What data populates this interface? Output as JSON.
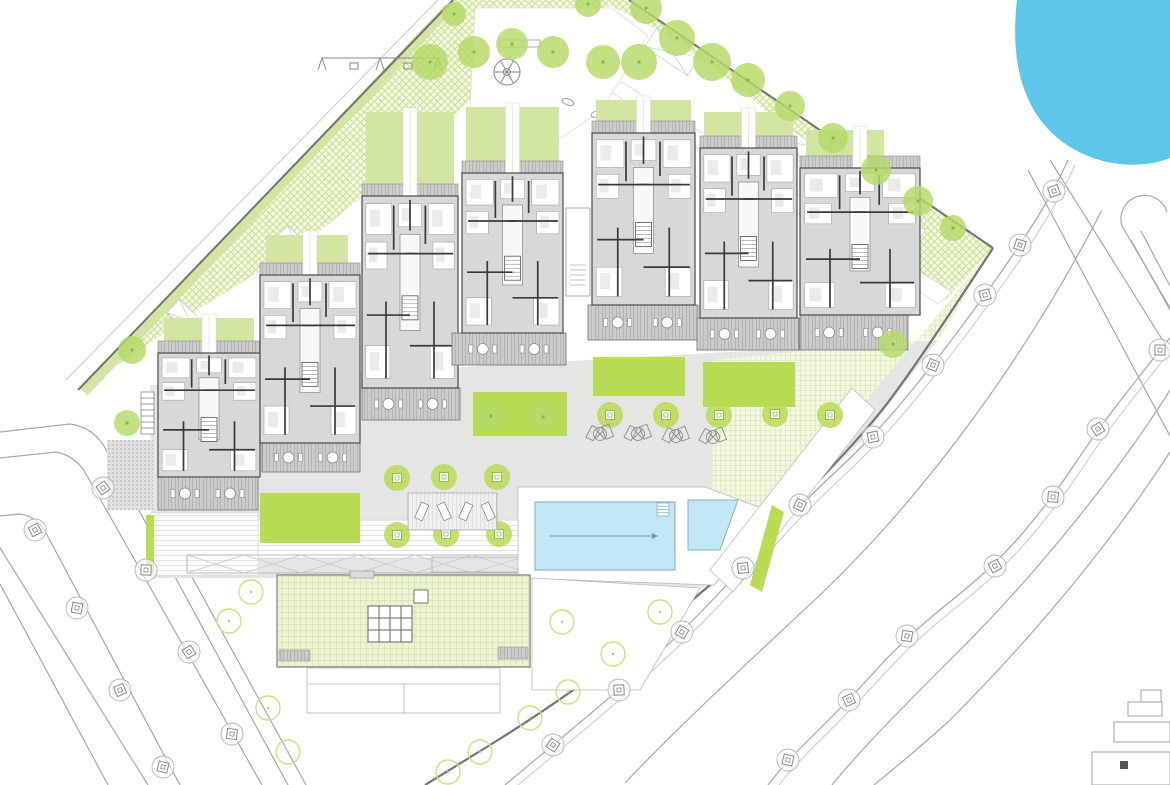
{
  "canvas": {
    "w": 1170,
    "h": 785
  },
  "colors": {
    "water": "#5ec6e9",
    "pool": "#c2e7f7",
    "pool_stroke": "#85b3c6",
    "tree_canopy": "#b5da68",
    "tree_dot": "#8cba42",
    "bed_bright": "#b9dc55",
    "strip_muted": "#d2e5a3",
    "hatch_line": "#c9e18e",
    "hatch_bg": "#f3f8e5",
    "grid_line": "#cbe292",
    "grid_bg": "#f2f7e2",
    "roof_line": "#c3dd8f",
    "roof_bg": "#ecf3d4",
    "building_fill": "#d8d8d8",
    "building_stroke": "#4a4a4a",
    "wall": "#3a3a3a",
    "room_stroke": "#9b9b9b",
    "balcony_bg": "#cbcbcb",
    "balcony_line": "#999999",
    "plaza": "#e5e5e3",
    "road": "#a8a8a8",
    "road_light": "#c9c9c9",
    "boundary": "#757575",
    "outline_tree": "#cbe283",
    "street_tree_circle": "#b5b5b5",
    "street_tree_square": "#8a8a8a",
    "white": "#ffffff"
  },
  "water": {
    "path": "M 1017,0 C 1010,60 1022,110 1060,140 C 1095,167 1140,170 1170,158 L 1170,0 Z"
  },
  "roads": {
    "plain": [
      "M 0,432 L 70,424 Q 92,427 104,446 L 288,785",
      "M 0,458 L 56,452 Q 76,456 86,474 L 262,785",
      "M 118,442 L 306,785",
      "M 0,516 L 20,514 Q 38,517 46,533 L 180,785",
      "M 0,548 L 148,785",
      "M 0,584 L 108,785",
      "M 1102,210 C 1030,350 930,490 820,595 C 740,670 680,725 625,783",
      "M 1170,390 C 1120,470 1040,570 960,650 C 900,710 862,748 832,785",
      "M 1170,452 C 1110,545 1030,640 950,720 C 915,752 892,770 874,785",
      "M 1028,170 L 1170,436",
      "M 1050,160 L 1170,352"
    ],
    "capsule": [
      "M 1122,226 A 22,22 0 1 1 1167,212",
      "M 1122,226 L 1170,308",
      "M 1131,240 L 1170,310",
      "M 1141,231 L 1170,286"
    ],
    "rows": [
      {
        "pts": [
          [
            1068,
            160
          ],
          [
            1054,
            191
          ],
          [
            1020,
            245
          ],
          [
            985,
            295
          ],
          [
            933,
            365
          ],
          [
            873,
            437
          ],
          [
            800,
            505
          ],
          [
            743,
            568
          ],
          [
            682,
            632
          ],
          [
            619,
            690
          ],
          [
            553,
            745
          ],
          [
            505,
            785
          ]
        ]
      },
      {
        "pts": [
          [
            1170,
            338
          ],
          [
            1160,
            350
          ],
          [
            1098,
            429
          ],
          [
            1053,
            497
          ],
          [
            995,
            566
          ],
          [
            907,
            636
          ],
          [
            849,
            700
          ],
          [
            788,
            760
          ],
          [
            768,
            785
          ]
        ]
      }
    ]
  },
  "boundaries": {
    "left": [
      [
        453,
        0
      ],
      [
        78,
        390
      ]
    ],
    "left_green": [
      [
        449,
        8
      ],
      [
        84,
        392
      ]
    ],
    "left_outer": [
      [
        438,
        0
      ],
      [
        66,
        380
      ]
    ],
    "ne": [
      [
        629,
        0
      ],
      [
        993,
        248
      ]
    ],
    "se": [
      [
        993,
        248
      ],
      [
        920,
        360
      ],
      [
        858,
        442
      ],
      [
        712,
        588
      ],
      [
        555,
        705
      ],
      [
        425,
        785
      ]
    ]
  },
  "hatch": {
    "band_left": [
      [
        453,
        0
      ],
      [
        618,
        0
      ],
      [
        472,
        98
      ],
      [
        418,
        152
      ],
      [
        300,
        247
      ],
      [
        205,
        305
      ],
      [
        130,
        357
      ],
      [
        78,
        390
      ]
    ],
    "band_right": [
      [
        600,
        0
      ],
      [
        629,
        0
      ],
      [
        993,
        248
      ],
      [
        946,
        300
      ],
      [
        758,
        104
      ],
      [
        678,
        40
      ]
    ],
    "east_garden": [
      [
        713,
        360
      ],
      [
        940,
        338
      ],
      [
        993,
        248
      ],
      [
        712,
        587
      ]
    ]
  },
  "plaza": {
    "poly": [
      [
        150,
        385
      ],
      [
        938,
        340
      ],
      [
        860,
        442
      ],
      [
        712,
        588
      ],
      [
        530,
        578
      ],
      [
        152,
        578
      ]
    ],
    "dotted": [
      107,
      440,
      46,
      70
    ],
    "steps": [
      [
        150,
        513,
        108,
        62
      ],
      [
        258,
        520,
        272,
        38
      ]
    ],
    "sliver": [
      146,
      515,
      8,
      58
    ],
    "beds": [
      [
        473,
        392,
        94,
        44
      ],
      [
        593,
        357,
        92,
        39
      ],
      [
        703,
        362,
        92,
        45
      ],
      [
        260,
        493,
        100,
        50
      ]
    ]
  },
  "pergola": {
    "rect": [
      187,
      555,
      343,
      18
    ],
    "inner": [
      432,
      557,
      95,
      15
    ],
    "cell": 57
  },
  "pools": {
    "deck": [
      [
        518,
        487
      ],
      [
        705,
        487
      ],
      [
        772,
        512
      ],
      [
        714,
        585
      ],
      [
        518,
        578
      ]
    ],
    "main": {
      "rect": [
        535,
        502,
        140,
        68
      ],
      "arrow": [
        [
          549,
          536
        ],
        [
          658,
          536
        ]
      ],
      "ladder": [
        657,
        503,
        12,
        13
      ]
    },
    "kids": [
      [
        688,
        500
      ],
      [
        738,
        500
      ],
      [
        720,
        550
      ],
      [
        688,
        550
      ]
    ],
    "ramp": [
      [
        852,
        388
      ],
      [
        875,
        410
      ],
      [
        733,
        592
      ],
      [
        710,
        570
      ]
    ],
    "ramp_sliver": [
      [
        772,
        505
      ],
      [
        784,
        512
      ],
      [
        762,
        592
      ],
      [
        750,
        585
      ]
    ]
  },
  "green_roof": {
    "rect": [
      277,
      575,
      253,
      92
    ],
    "skylight": {
      "rect": [
        368,
        606,
        44,
        36
      ],
      "cols": 4,
      "rows": 3
    },
    "small_sq": [
      414,
      590,
      14,
      13
    ],
    "strips": [
      [
        279,
        650,
        31,
        11
      ],
      [
        498,
        647,
        30,
        12
      ]
    ],
    "tab": [
      350,
      571,
      24,
      7
    ]
  },
  "terraces": {
    "left": {
      "rect": [
        307,
        668,
        193,
        45
      ],
      "hline_y": 684,
      "vline_x": 404
    },
    "right": [
      [
        532,
        578
      ],
      [
        700,
        588
      ],
      [
        640,
        690
      ],
      [
        532,
        690
      ]
    ]
  },
  "stairs_west": [
    141,
    392,
    13,
    42
  ],
  "connectors": [
    {
      "x": 566,
      "y": 208,
      "w": 24,
      "h": 88
    }
  ],
  "walks": {
    "diag": [
      [
        608,
        90
      ],
      [
        622,
        82
      ],
      [
        952,
        292
      ],
      [
        938,
        304
      ]
    ],
    "crossings_right": [
      [
        672,
        52,
        -56
      ],
      [
        790,
        142,
        -56
      ],
      [
        898,
        224,
        -56
      ]
    ],
    "crossings_left": [
      [
        414,
        150,
        44
      ],
      [
        298,
        248,
        44
      ],
      [
        190,
        322,
        44
      ]
    ]
  },
  "buildings": [
    {
      "id": "b1",
      "x": 158,
      "y": 353,
      "w": 102,
      "h": 124,
      "balcony": [
        158,
        477,
        100,
        33
      ],
      "garden": [
        164,
        318,
        90,
        35
      ]
    },
    {
      "id": "b2",
      "x": 260,
      "y": 275,
      "w": 100,
      "h": 168,
      "balcony": [
        262,
        443,
        98,
        29
      ],
      "garden": [
        266,
        235,
        82,
        40
      ]
    },
    {
      "id": "b3",
      "x": 362,
      "y": 196,
      "w": 96,
      "h": 192,
      "balcony": [
        362,
        388,
        98,
        32
      ],
      "garden": [
        366,
        112,
        88,
        84
      ]
    },
    {
      "id": "b4",
      "x": 462,
      "y": 173,
      "w": 101,
      "h": 160,
      "balcony": [
        452,
        333,
        114,
        32
      ],
      "garden": [
        466,
        107,
        93,
        55
      ]
    },
    {
      "id": "b5",
      "x": 592,
      "y": 133,
      "w": 103,
      "h": 172,
      "balcony": [
        588,
        305,
        110,
        35
      ],
      "garden": [
        596,
        100,
        95,
        22
      ]
    },
    {
      "id": "b6",
      "x": 700,
      "y": 148,
      "w": 97,
      "h": 170,
      "balcony": [
        697,
        318,
        102,
        32
      ],
      "garden": [
        704,
        112,
        89,
        25
      ]
    },
    {
      "id": "b7",
      "x": 800,
      "y": 168,
      "w": 120,
      "h": 147,
      "balcony": [
        800,
        315,
        108,
        35
      ],
      "garden": [
        806,
        130,
        78,
        27
      ]
    }
  ],
  "playground": {
    "area": [
      [
        475,
        8
      ],
      [
        612,
        8
      ],
      [
        648,
        36
      ],
      [
        600,
        112
      ],
      [
        545,
        148
      ],
      [
        470,
        108
      ]
    ],
    "swing": {
      "x1": 322,
      "x2": 438,
      "y": 58,
      "seats": [
        [
          350,
          63
        ],
        [
          404,
          63
        ]
      ]
    },
    "bench": [
      500,
      40,
      40,
      7
    ],
    "roundabout": {
      "c": [
        507,
        72
      ],
      "r": 13,
      "spokes": 6
    },
    "riders": [
      [
        568,
        102,
        20
      ],
      [
        597,
        114,
        -15
      ]
    ]
  },
  "trees": {
    "canopy": [
      [
        430,
        62,
        18
      ],
      [
        474,
        52,
        16
      ],
      [
        512,
        44,
        16
      ],
      [
        553,
        52,
        16
      ],
      [
        603,
        62,
        17
      ],
      [
        639,
        62,
        18
      ],
      [
        677,
        38,
        18
      ],
      [
        712,
        62,
        19
      ],
      [
        748,
        80,
        17
      ],
      [
        646,
        8,
        16
      ],
      [
        588,
        4,
        13
      ],
      [
        454,
        14,
        12
      ],
      [
        790,
        106,
        15
      ],
      [
        833,
        138,
        15
      ],
      [
        876,
        170,
        15
      ],
      [
        918,
        201,
        15
      ],
      [
        953,
        228,
        13
      ],
      [
        132,
        350,
        14
      ],
      [
        893,
        344,
        14
      ],
      [
        127,
        423,
        13
      ],
      [
        491,
        416,
        16
      ],
      [
        543,
        417,
        16
      ]
    ],
    "grate": [
      [
        397,
        478
      ],
      [
        444,
        477
      ],
      [
        497,
        477
      ],
      [
        397,
        535
      ],
      [
        446,
        534
      ],
      [
        499,
        534
      ],
      [
        610,
        415
      ],
      [
        666,
        415
      ],
      [
        719,
        415
      ],
      [
        775,
        414
      ],
      [
        830,
        415
      ]
    ],
    "outline": [
      [
        562,
        622
      ],
      [
        660,
        612
      ],
      [
        613,
        654
      ],
      [
        568,
        692
      ],
      [
        530,
        718
      ],
      [
        480,
        752
      ],
      [
        448,
        772
      ],
      [
        251,
        592
      ],
      [
        229,
        621
      ],
      [
        268,
        708
      ],
      [
        288,
        752
      ]
    ],
    "street": [
      [
        103,
        488
      ],
      [
        146,
        570
      ],
      [
        189,
        652
      ],
      [
        232,
        734
      ],
      [
        35,
        530
      ],
      [
        77,
        608
      ],
      [
        120,
        690
      ],
      [
        163,
        767
      ],
      [
        1054,
        191
      ],
      [
        1020,
        245
      ],
      [
        985,
        295
      ],
      [
        933,
        365
      ],
      [
        873,
        437
      ],
      [
        800,
        505
      ],
      [
        743,
        568
      ],
      [
        682,
        632
      ],
      [
        619,
        690
      ],
      [
        553,
        745
      ],
      [
        1160,
        350
      ],
      [
        1098,
        429
      ],
      [
        1053,
        497
      ],
      [
        995,
        566
      ],
      [
        907,
        636
      ],
      [
        849,
        700
      ],
      [
        788,
        760
      ]
    ]
  },
  "loungers": {
    "groups": [
      [
        600,
        432
      ],
      [
        638,
        432
      ],
      [
        676,
        434
      ],
      [
        713,
        435
      ]
    ],
    "deck": {
      "rect": [
        408,
        493,
        89,
        37
      ],
      "items": [
        418,
        440,
        462,
        484
      ]
    }
  },
  "fragment": {
    "rects": [
      [
        1141,
        690,
        20,
        12
      ],
      [
        1128,
        702,
        34,
        14
      ],
      [
        1114,
        722,
        56,
        20
      ],
      [
        1092,
        752,
        78,
        33
      ]
    ],
    "dark": [
      1120,
      761,
      8,
      8
    ]
  }
}
